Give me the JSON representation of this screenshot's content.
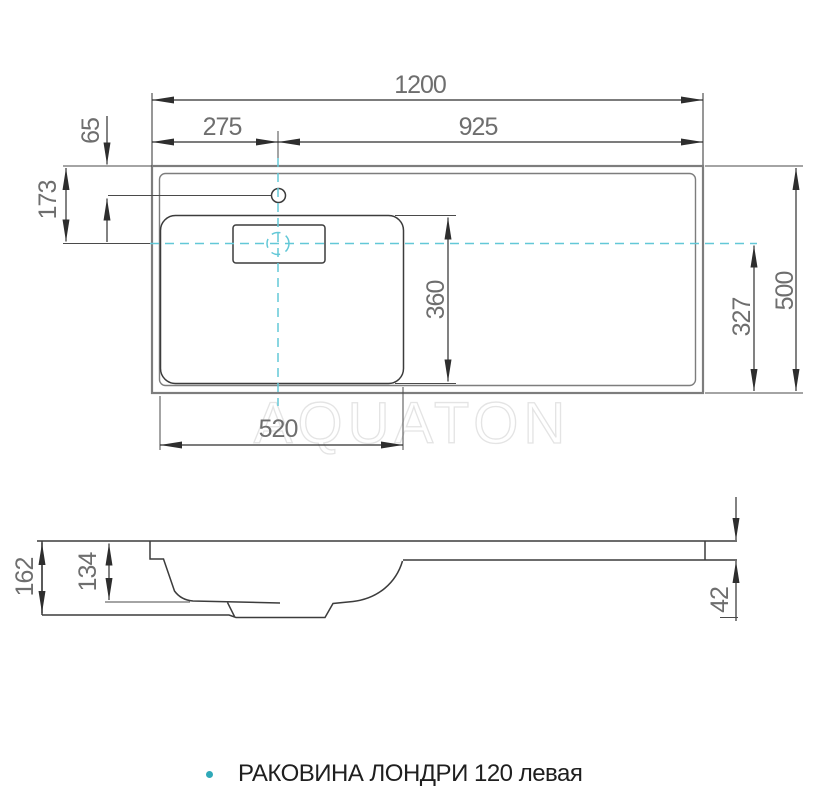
{
  "caption": {
    "text": "РАКОВИНА ЛОНДРИ 120 левая",
    "bullet_color": "#2fa9b8"
  },
  "watermark": {
    "text": "AQUATON"
  },
  "top_view": {
    "dims": {
      "total_width": "1200",
      "faucet_offset_left": "275",
      "faucet_offset_right": "925",
      "faucet_from_top_edge": "65",
      "centerline_from_top": "173",
      "total_depth": "500",
      "centerline_to_bottom": "327",
      "basin_depth": "360",
      "basin_width": "520"
    }
  },
  "side_view": {
    "dims": {
      "total_height": "162",
      "bowl_inner_depth": "134",
      "counter_thickness": "42"
    }
  },
  "colors": {
    "centerline_cyan": "#63c8d7",
    "outline_gray": "#7d7d7d",
    "profile_line": "#3c3c3c",
    "dimension_line": "#2e2e2e",
    "dimension_text": "#6e6e6e",
    "watermark_gray": "#e4e4e4",
    "caption_text": "#1f1f1f"
  }
}
